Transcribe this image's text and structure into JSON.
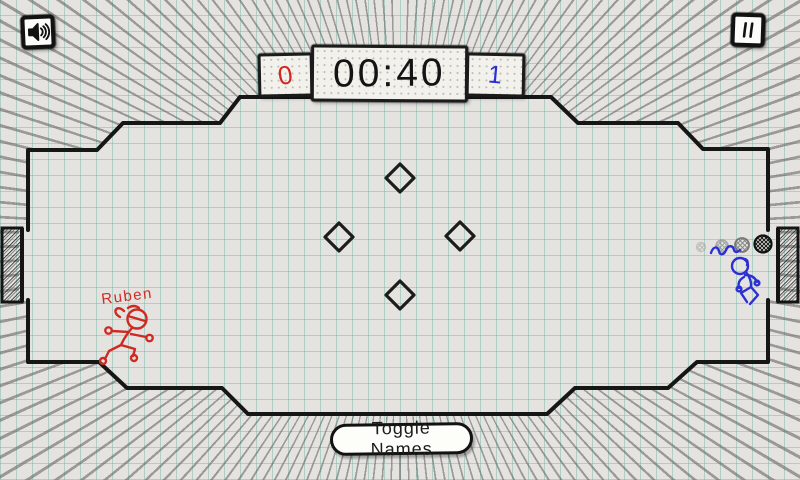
{
  "hud": {
    "sound_button": {
      "icon": "speaker-icon"
    },
    "pause_button": {
      "icon": "pause-icon"
    },
    "scoreboard": {
      "left_score": "0",
      "timer": "00:40",
      "right_score": "1",
      "left_score_color": "#d0281f",
      "right_score_color": "#2b2fd4"
    },
    "toggle_names_button": {
      "label": "Toggle Names"
    }
  },
  "players": {
    "red": {
      "name": "Ruben",
      "color": "#cf2a22",
      "side": "left"
    },
    "blue": {
      "color": "#2b2fd4",
      "side": "right"
    }
  },
  "ball": {
    "style": "doodle-crosshatch",
    "trail_ghosts": 3
  },
  "field": {
    "obstacle_shape": "diamond",
    "obstacle_count": 4,
    "goals": [
      "left",
      "right"
    ]
  },
  "colors": {
    "paper": "#e5e3df",
    "grid": "#60b4a4",
    "ink": "#1b1b1b",
    "hatch": "#686868"
  }
}
